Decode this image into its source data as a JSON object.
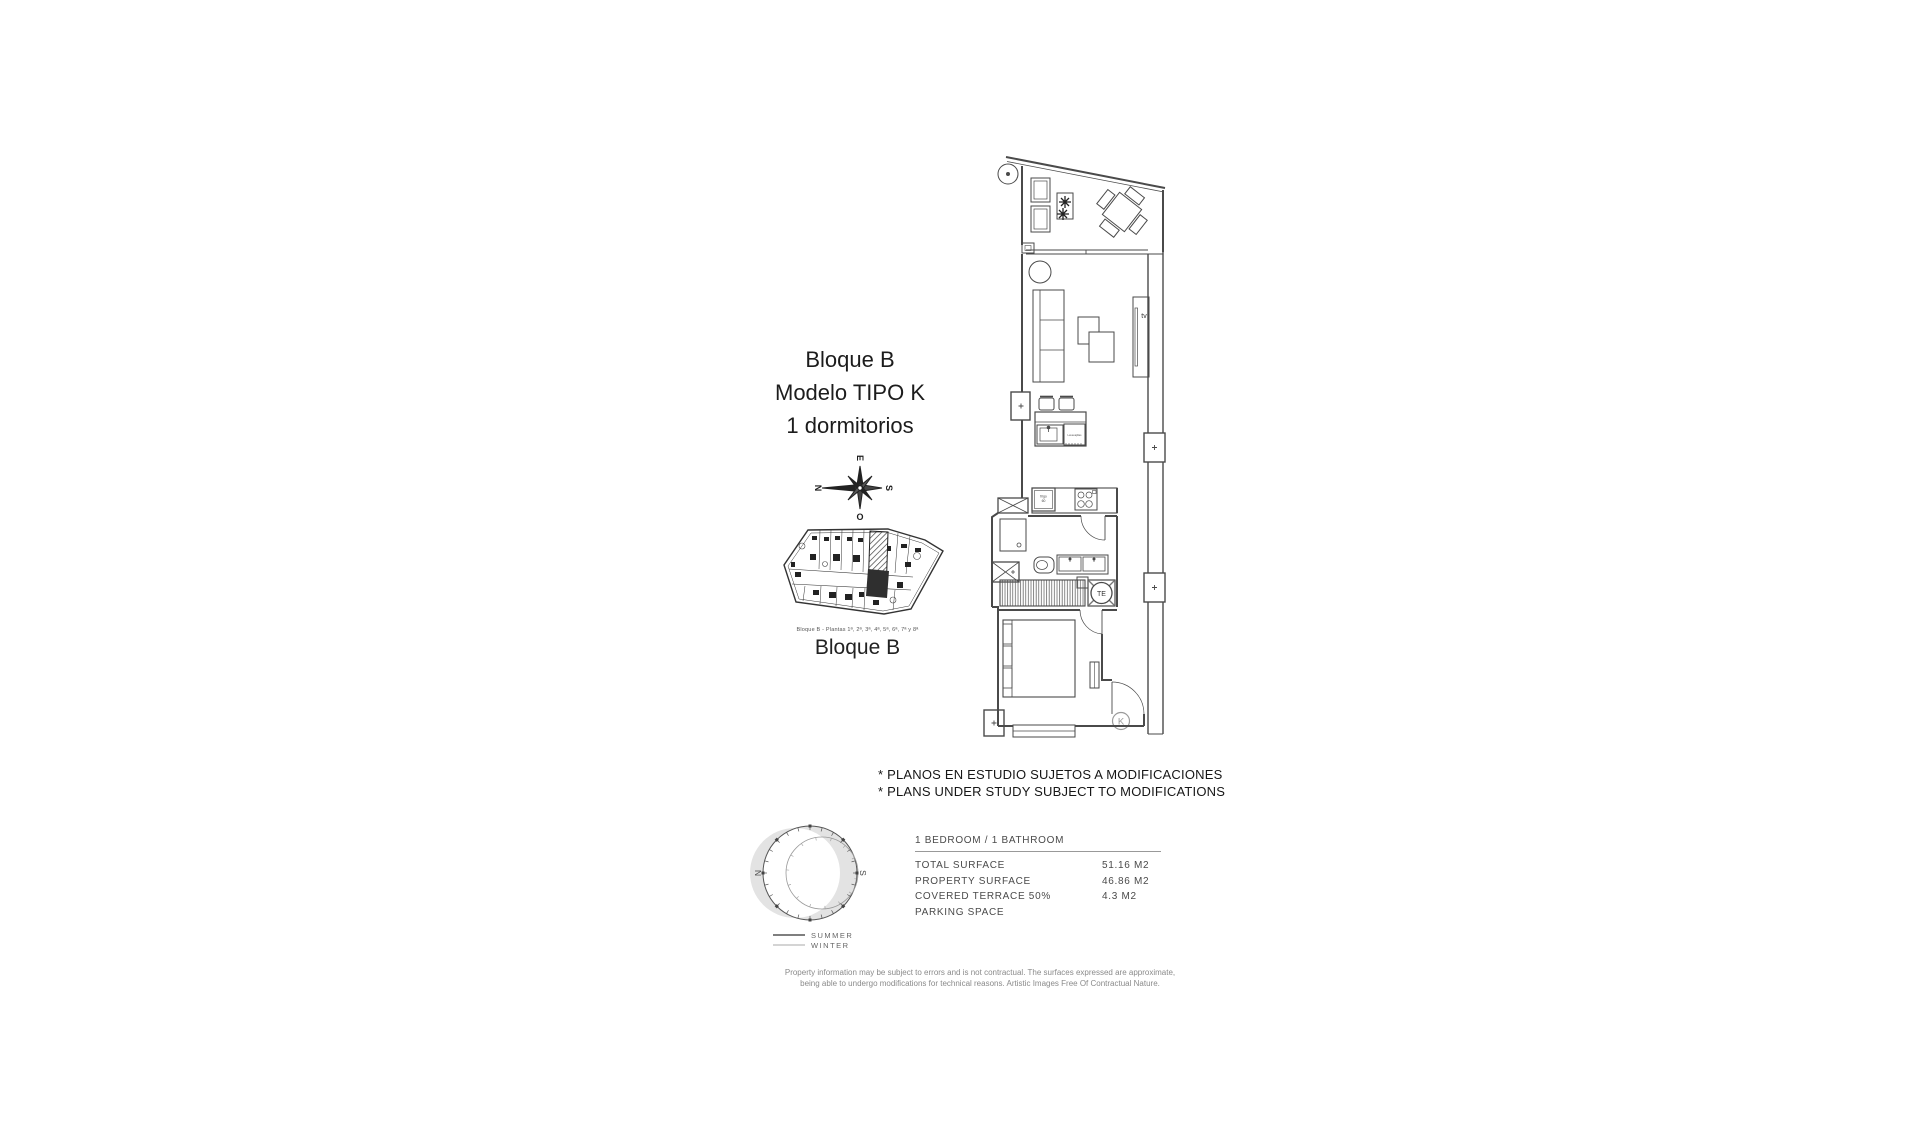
{
  "title_block": {
    "line1": "Bloque B",
    "line2": "Modelo TIPO K",
    "line3": "1 dormitorios"
  },
  "compass": {
    "east": "E",
    "south": "S",
    "west": "O",
    "north": "N"
  },
  "block_map": {
    "caption": "Bloque B - Plantas 1ª, 2ª, 3ª, 4ª, 5ª, 6ª, 7ª y 8ª",
    "label": "Bloque B"
  },
  "floor_plan": {
    "labels": {
      "tv": "tv",
      "fridge_line1": "frigo",
      "fridge_line2": "60",
      "dishwasher": "Lavavajillas",
      "te": "TE",
      "unit_letter": "K"
    }
  },
  "notes": {
    "line1": "* PLANOS EN ESTUDIO SUJETOS A MODIFICACIONES",
    "line2": "* PLANS UNDER STUDY SUBJECT TO MODIFICATIONS"
  },
  "sun_diagram": {
    "north": "N",
    "south": "S",
    "legend": [
      {
        "label": "SUMMER"
      },
      {
        "label": "WINTER"
      }
    ]
  },
  "spec_table": {
    "header": "1 BEDROOM / 1 BATHROOM",
    "rows": [
      {
        "label": "TOTAL SURFACE",
        "value": "51.16 M2"
      },
      {
        "label": "PROPERTY SURFACE",
        "value": "46.86 M2"
      },
      {
        "label": "COVERED TERRACE 50%",
        "value": "4.3 M2"
      },
      {
        "label": "PARKING SPACE",
        "value": ""
      }
    ]
  },
  "disclaimer": {
    "line1": "Property information may be subject to errors and is not contractual. The surfaces expressed are approximate,",
    "line2": "being able to undergo modifications for technical reasons. Artistic Images Free Of Contractual Nature."
  },
  "colors": {
    "line": "#4a4a4a",
    "light_line": "#8a8a8a",
    "shade": "#e3e3e3",
    "map_dark": "#2f2f2f"
  }
}
